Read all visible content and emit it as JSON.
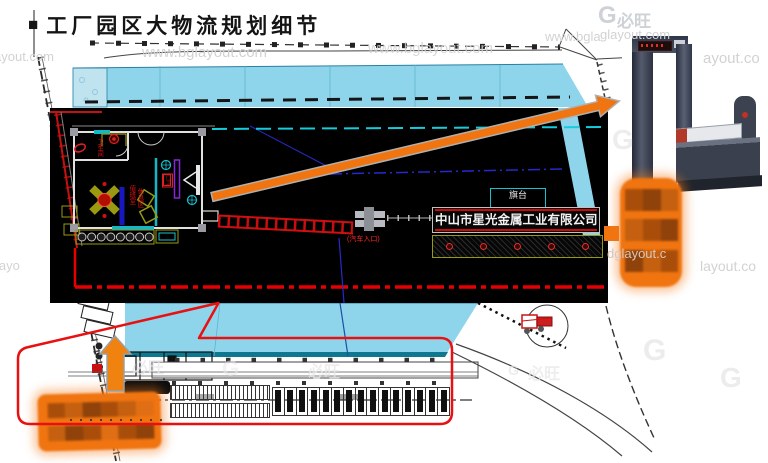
{
  "slide": {
    "bullet": "■",
    "title": "工厂园区大物流规划细节"
  },
  "inset": {
    "company_sign": "中山市星光金属工业有限公司",
    "flag_platform": "旗台",
    "vehicle_entrance": "(汽车入口)",
    "room_labels": [
      "卫生间",
      "值班室",
      "休息区",
      "门卫"
    ]
  },
  "watermarks": {
    "brand": "必旺",
    "logo": "G",
    "url": "www.bglayout.com",
    "fragments": {
      "f1": "ayout.com",
      "f2": "ayout.co",
      "f3": "glayout.com",
      "f4": "layout.co",
      "f5": "dglayout.c",
      "f6": "layo",
      "f7": "www.bgla"
    }
  },
  "colors": {
    "accent_orange": "#f0740f",
    "highlight_red": "#e81010",
    "roof_cyan": "#8ed5ec",
    "cad_teal": "#14ccdc",
    "cad_navy": "#2828cc",
    "cad_olive": "#9a9a10",
    "cad_purple": "#8428d8",
    "panel_black": "#000000",
    "watermark_gray": "#d2d2d2"
  }
}
